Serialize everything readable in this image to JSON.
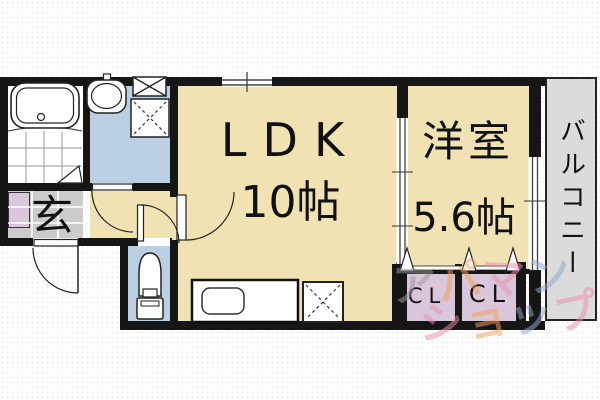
{
  "plan": {
    "rooms": {
      "ldk": {
        "label": "LDK",
        "size": "10帖"
      },
      "western_room": {
        "label": "洋室",
        "size": "5.6帖"
      },
      "balcony": {
        "label": "バルコニー"
      },
      "entrance": {
        "label": "玄"
      },
      "closet_left": {
        "label": "CL"
      },
      "closet_right": {
        "label": "CL"
      }
    },
    "fixture_icons": [
      "bathtub-icon",
      "washbasin-icon",
      "washing-machine-space-icon",
      "toilet-icon",
      "kitchen-sink-icon",
      "refrigerator-space-icon",
      "door-swing-icon",
      "sliding-window-icon",
      "folding-door-icon"
    ],
    "colors": {
      "floor_beige": "#f1e2b3",
      "wet_area_blue": "#bacfe2",
      "closet_purple": "#d9c6db",
      "entrance_tile_gray": "#cbcbcb",
      "balcony_gray": "#dbdbdb",
      "wall_black": "#161616"
    }
  },
  "watermark": {
    "line1_chars": [
      {
        "ch": "ア",
        "color": "#9a9a9a"
      },
      {
        "ch": "パ",
        "color": "#f0a058"
      },
      {
        "ch": "マ",
        "color": "#ec8fae"
      },
      {
        "ch": "ン",
        "color": "#8ea8c6"
      }
    ],
    "line2_chars": [
      {
        "ch": "シ",
        "color": "#ec8fae"
      },
      {
        "ch": "ョ",
        "color": "#f0a058"
      },
      {
        "ch": "ッ",
        "color": "#8ea8c6"
      },
      {
        "ch": "プ",
        "color": "#ec8fae"
      }
    ]
  }
}
